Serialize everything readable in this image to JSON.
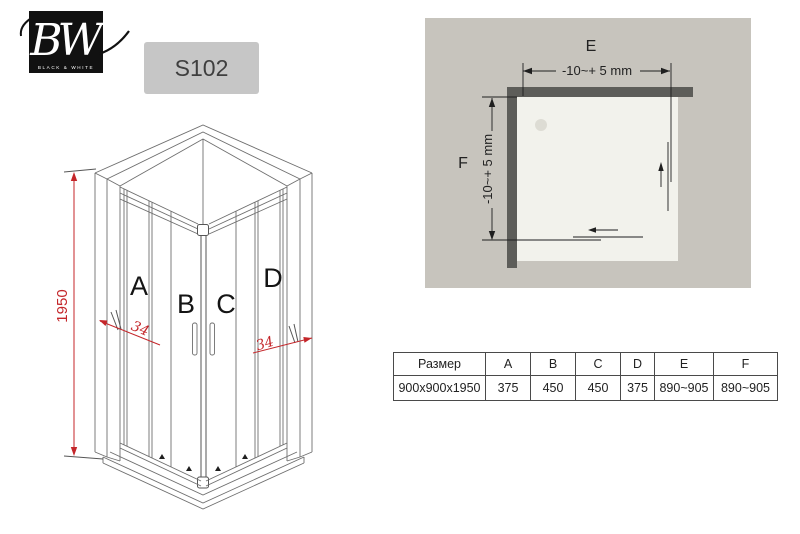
{
  "logo": {
    "script": "BW",
    "subtext": "BLACK & WHITE"
  },
  "model_badge": {
    "label": "S102"
  },
  "front_view": {
    "height_dim": "1950",
    "left_adjust": "34",
    "right_adjust": "34",
    "panel_a": "A",
    "panel_b": "B",
    "panel_c": "C",
    "panel_d": "D"
  },
  "top_view": {
    "width_label": "E",
    "height_label": "F",
    "width_tolerance": "-10~+ 5 mm",
    "height_tolerance": "-10~+ 5 mm"
  },
  "spec_table": {
    "headers": [
      "Размер",
      "A",
      "B",
      "C",
      "D",
      "E",
      "F"
    ],
    "row": [
      "900x900x1950",
      "375",
      "450",
      "450",
      "375",
      "890~905",
      "890~905"
    ]
  },
  "colors": {
    "accent_red": "#c4262a",
    "plan_panel_gray": "#c7c4bd",
    "plan_wall_gray": "#5d5d59",
    "plan_tray_white": "#f2f2ec",
    "badge_gray": "#c6c6c6",
    "logo_black": "#111111"
  }
}
